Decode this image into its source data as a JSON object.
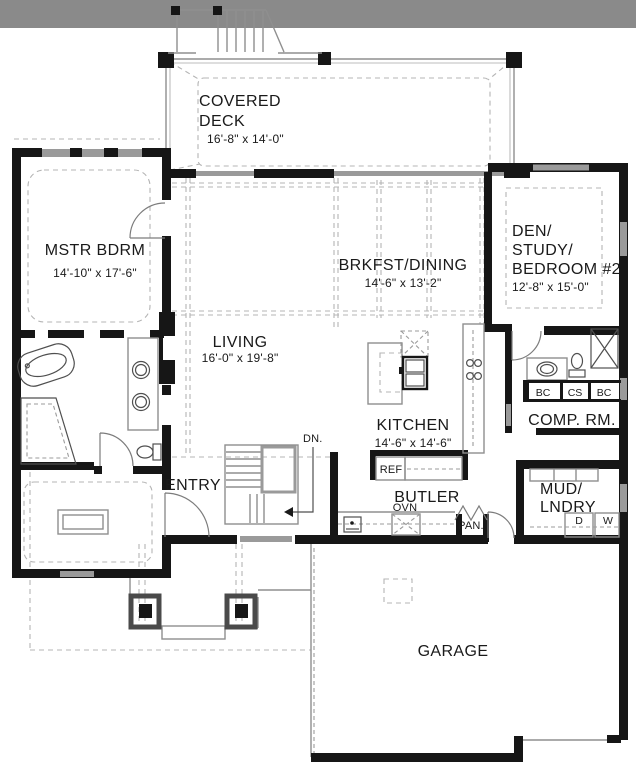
{
  "document": {
    "type": "floor-plan"
  },
  "rooms": {
    "covered_deck": {
      "line1": "COVERED",
      "line2": "DECK",
      "dims": "16'-8\" x 14'-0\""
    },
    "mstr_bdrm": {
      "name": "MSTR BDRM",
      "dims": "14'-10\" x 17'-6\""
    },
    "living": {
      "name": "LIVING",
      "dims": "16'-0\" x 19'-8\""
    },
    "brkfst_dining": {
      "name": "BRKFST/DINING",
      "dims": "14'-6\" x 13'-2\""
    },
    "den": {
      "line1": "DEN/",
      "line2": "STUDY/",
      "line3": "BEDROOM #2",
      "dims": "12'-8\" x 15'-0\""
    },
    "kitchen": {
      "name": "KITCHEN",
      "dims": "14'-6\" x 14'-6\""
    },
    "entry": {
      "name": "ENTRY"
    },
    "butler": {
      "name": "BUTLER"
    },
    "comp_rm": {
      "name": "COMP. RM."
    },
    "mud_lndry": {
      "line1": "MUD/",
      "line2": "LNDRY"
    },
    "garage": {
      "name": "GARAGE"
    }
  },
  "annotations": {
    "dn": "DN.",
    "ovn": "OVN",
    "ref": "REF",
    "pan": "PAN.",
    "bc1": "BC",
    "cs": "CS",
    "bc2": "BC",
    "dryer": "D",
    "washer": "W"
  },
  "colors": {
    "wall": "#161616",
    "window_fill": "#9a9a9a",
    "top_band": "#8a8a8a",
    "dashed_line": "#b4b4b4",
    "fixture_line": "#4f4f4f",
    "text": "#1a1a1a",
    "background": "#ffffff"
  }
}
